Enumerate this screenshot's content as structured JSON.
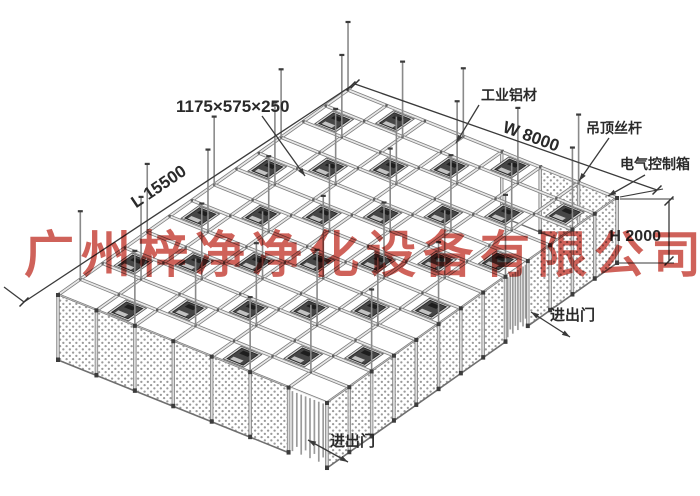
{
  "watermark": "广州梓净净化设备有限公司",
  "labels": {
    "module_size": "1175×575×250",
    "aluminum": "工业铝材",
    "width": "W 8000",
    "hanger_rod": "吊顶丝杆",
    "control_box": "电气控制箱",
    "height": "H 2000",
    "length": "L 15500",
    "door_right": "进出门",
    "door_bottom": "进出门"
  },
  "structure": {
    "grid_cols": 13,
    "grid_rows": 7,
    "wall_height_px": 65,
    "long_wall_door_panel": 8,
    "end_wall_door_panel": 6,
    "ffu_rule_mod": 3,
    "colors": {
      "beam_edge": "#7d7d7d",
      "beam_fill": "#e8e8e8",
      "post_edge": "#7f7f7f",
      "post_fill": "#dcdcdc",
      "ffu_frame": "#d6d6d6",
      "ffu_body": "#464646",
      "dot": "#9a9a9a",
      "annotation": "#3a3a3a",
      "node": "#5f5f5f",
      "watermark_red": "#c33a30"
    }
  }
}
